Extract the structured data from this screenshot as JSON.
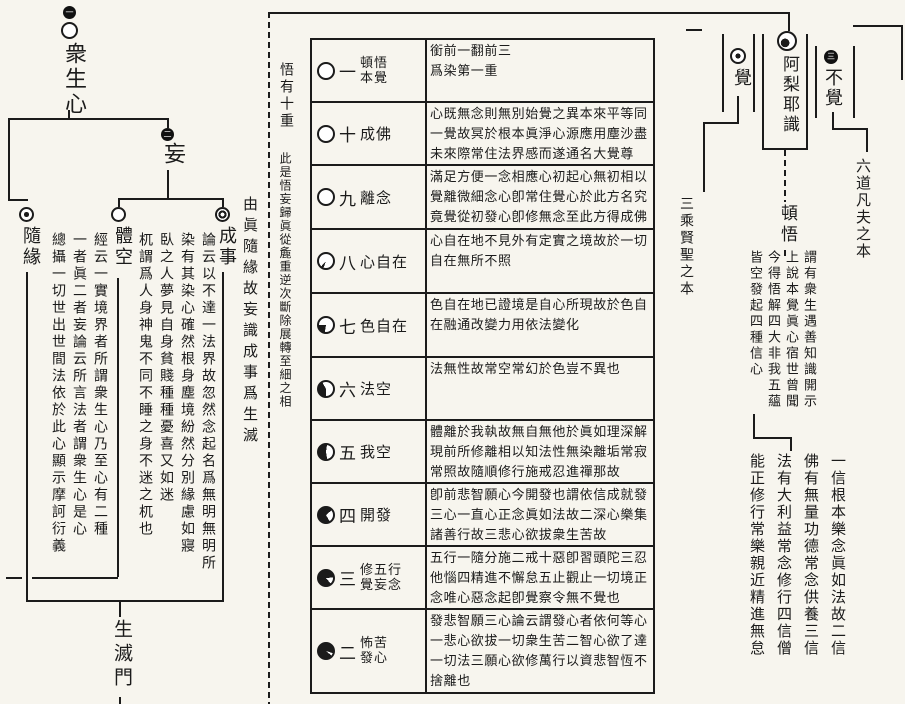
{
  "page": {
    "paper_color": "#f7f5ee",
    "ink_color": "#1b1b1b",
    "kind": "scanned buddhist chart page"
  },
  "left": {
    "root_badge": "一",
    "root_label": "衆生心",
    "wang_badge": "二",
    "wang_label": "妄",
    "branch_suiyuan": "隨緣",
    "branch_tikong": "體空",
    "branch_chengshi": "成事",
    "block_a": [
      "經云一實境界者所謂衆生心乃至心有二種",
      "一者眞二者妄論云所言法者謂衆生心是心",
      "總攝一切世出世間法依於此心顯示摩訶衍義"
    ],
    "block_b": [
      "論云以不達一法界故忽然念起名爲無明無明所",
      "染有其染心確然根身塵境紛然分別緣慮如寢",
      "臥之人夢見自身貧賤種種憂喜又如迷",
      "杌謂爲人身神鬼不同不睡之身不迷之杌也"
    ],
    "side_note": "由眞隨緣故妄識成事爲生滅",
    "gate_label": "生滅門"
  },
  "table": {
    "intro_head": "悟有十重",
    "intro_body": "此是悟妄歸眞從麁重逆次斷除展轉至細之相",
    "side_label": "三乘賢聖之本",
    "rows": [
      {
        "num": "一",
        "t1": "頓悟",
        "t2": "本覺",
        "black_pct": 0,
        "content": "銜前一翻前三\n爲染第一重"
      },
      {
        "num": "十",
        "t1": "成佛",
        "t2": "",
        "black_pct": 0,
        "content": "心既無念則無別始覺之異本來平等同一覺故冥於根本眞淨心源應用塵沙盡未來際常住法界感而遂通名大覺尊"
      },
      {
        "num": "九",
        "t1": "離念",
        "t2": "",
        "black_pct": 0,
        "content": "滿足方便一念相應心初起心無初相以覺離微細念心卽常住覺心於此方名究竟覺從初發心卽修無念至此方得成佛"
      },
      {
        "num": "八",
        "t1": "心自在",
        "t2": "",
        "black_pct": 6,
        "content": "心自在地不見外有定實之境故於一切自在無所不照"
      },
      {
        "num": "七",
        "t1": "色自在",
        "t2": "",
        "black_pct": 22,
        "content": "色自在地已證境是自心所現故於色自在融通改變力用依法變化"
      },
      {
        "num": "六",
        "t1": "法空",
        "t2": "",
        "black_pct": 42,
        "content": "法無性故常空常幻於色豈不異也"
      },
      {
        "num": "五",
        "t1": "我空",
        "t2": "",
        "black_pct": 55,
        "content": "體離於我執故無自無他於眞如理深解現前所修離相以知法性無染離垢常寂常照故隨順修行施戒忍進禪那故"
      },
      {
        "num": "四",
        "t1": "開發",
        "t2": "",
        "black_pct": 72,
        "content": "卽前悲智願心今開發也謂依信成就發三心一直心正念眞如法故二深心樂集諸善行故三悲心欲拔衆生苦故"
      },
      {
        "num": "三",
        "t1": "修五行",
        "t2": "覺妄念",
        "black_pct": 85,
        "content": "五行一隨分施二戒十惡卽習頭陀三忍他惱四精進不懈怠五止觀止一切境正念唯心惡念起卽覺察令無不覺也"
      },
      {
        "num": "二",
        "t1": "怖苦",
        "t2": "發心",
        "black_pct": 94,
        "content": "發悲智願三心論云謂發心者依何等心一悲心欲拔一切衆生苦二智心欲了達一切法三願心欲修萬行以資悲智恆不捨離也"
      }
    ]
  },
  "right": {
    "alaya_label": "阿梨耶識",
    "jue_label": "覺",
    "bujue_badge": "三",
    "bujue_label": "不覺",
    "dunwu_label": "頓悟",
    "six_realms_label": "六道凡夫之本",
    "note1": [
      "謂有衆生遇善知識開示",
      "上說本覺眞心宿世曾聞",
      "今得悟解四大非我五蘊",
      "皆空發起四種信心"
    ],
    "note2": [
      "一信根本樂念眞如法故二信",
      "佛有無量功德常念供養三信",
      "法有大利益常念修行四信僧",
      "能正修行常樂親近精進無怠"
    ]
  }
}
